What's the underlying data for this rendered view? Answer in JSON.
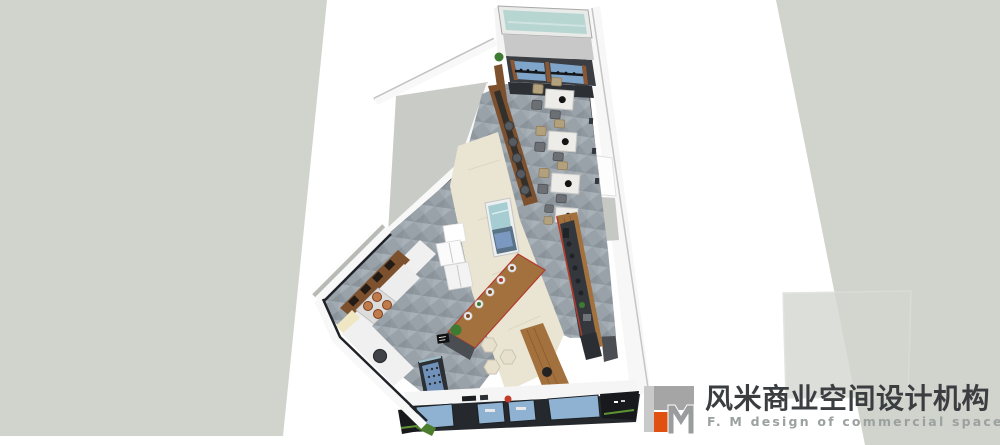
{
  "watermark": {
    "logo_monogram": "FM",
    "company_name_zh": "风米商业空间设计机构",
    "company_name_en": "F. M design of commercial space"
  },
  "palette": {
    "background": "#ffffff",
    "ground_plane": "#d1d3cd",
    "wall_white": "#f7f7f7",
    "wall_dark": "#3c4045",
    "floor_tile": "#99a1a9",
    "walkway_wood": "#eae5d3",
    "counter_wood": "#a3713d",
    "cabinet_wood": "#7d512e",
    "skylight_teal": "#b7d5d1",
    "window_blue": "#80a5ca",
    "storefront_glass": "#8fb2d2",
    "fridge_blue": "#7092ba",
    "accent_red": "#b23a2e",
    "plant_green": "#3d7a32",
    "chair_tan": "#b3a07c",
    "chair_gray": "#6c7074",
    "table_marble": "#edece8",
    "logo_orange": "#e0500e",
    "logo_gray": "#a5a5a5",
    "logo_text_dark": "#3b3e41",
    "logo_text_gray": "#9ba19f"
  }
}
